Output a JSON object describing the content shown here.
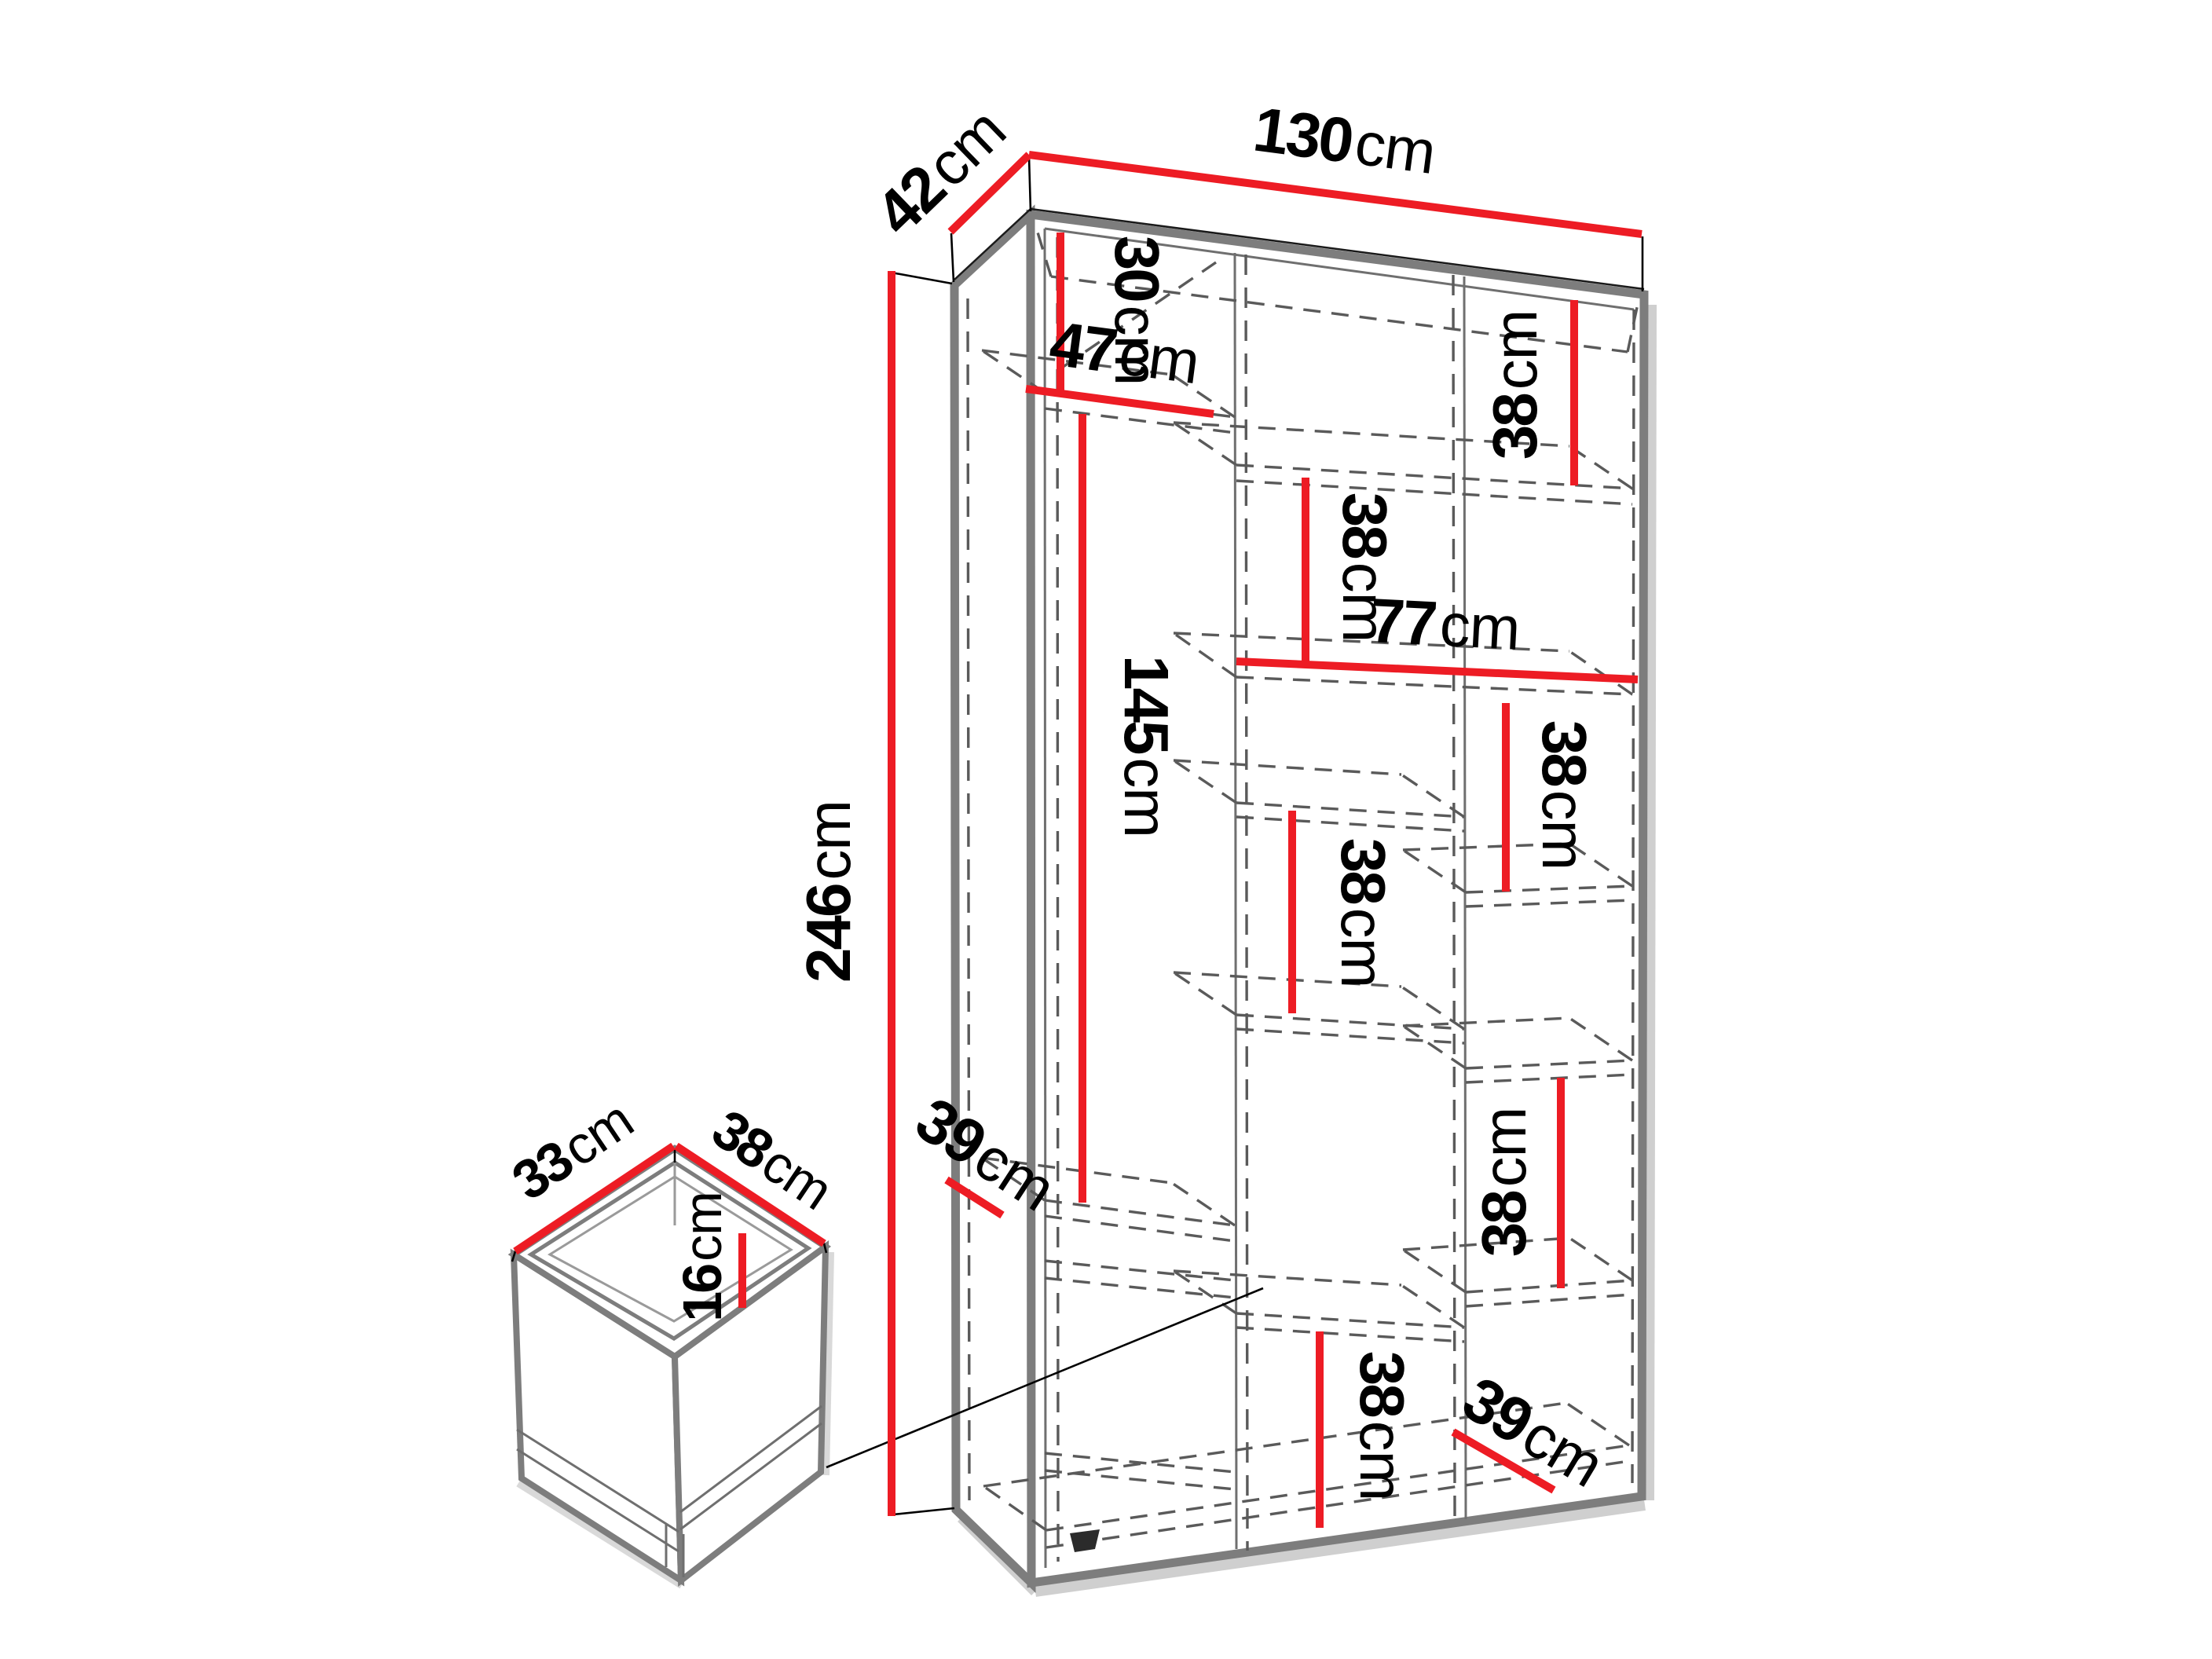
{
  "diagram": {
    "title": "wardrobe-dimension-diagram",
    "description": "Technical dimension drawing of a two-door wardrobe with interior shelving and a detail view of a drawer",
    "colors": {
      "dimension_line": "#ed1c24",
      "edge": "#7d7d7d",
      "dashed_line": "#5a5a5a",
      "text": "#000000",
      "background": "#ffffff"
    },
    "dims": {
      "width": {
        "v": "130",
        "u": "cm"
      },
      "depth": {
        "v": "42",
        "u": "cm"
      },
      "height": {
        "v": "246",
        "u": "cm"
      },
      "top_section": {
        "v": "30",
        "u": "cm"
      },
      "left_col_width": {
        "v": "47",
        "u": "cm"
      },
      "hanging_height": {
        "v": "145",
        "u": "cm"
      },
      "shelf_a": {
        "v": "38",
        "u": "cm"
      },
      "shelf_b": {
        "v": "38",
        "u": "cm"
      },
      "right_col_width": {
        "v": "77",
        "u": "cm"
      },
      "shelf_c": {
        "v": "38",
        "u": "cm"
      },
      "shelf_d": {
        "v": "38",
        "u": "cm"
      },
      "shelf_e": {
        "v": "38",
        "u": "cm"
      },
      "shelf_f": {
        "v": "38",
        "u": "cm"
      },
      "shelf_depth_left": {
        "v": "39",
        "u": "cm"
      },
      "shelf_depth_right": {
        "v": "39",
        "u": "cm"
      },
      "drawer_width": {
        "v": "33",
        "u": "cm"
      },
      "drawer_depth": {
        "v": "38",
        "u": "cm"
      },
      "drawer_height": {
        "v": "16",
        "u": "cm"
      }
    }
  }
}
